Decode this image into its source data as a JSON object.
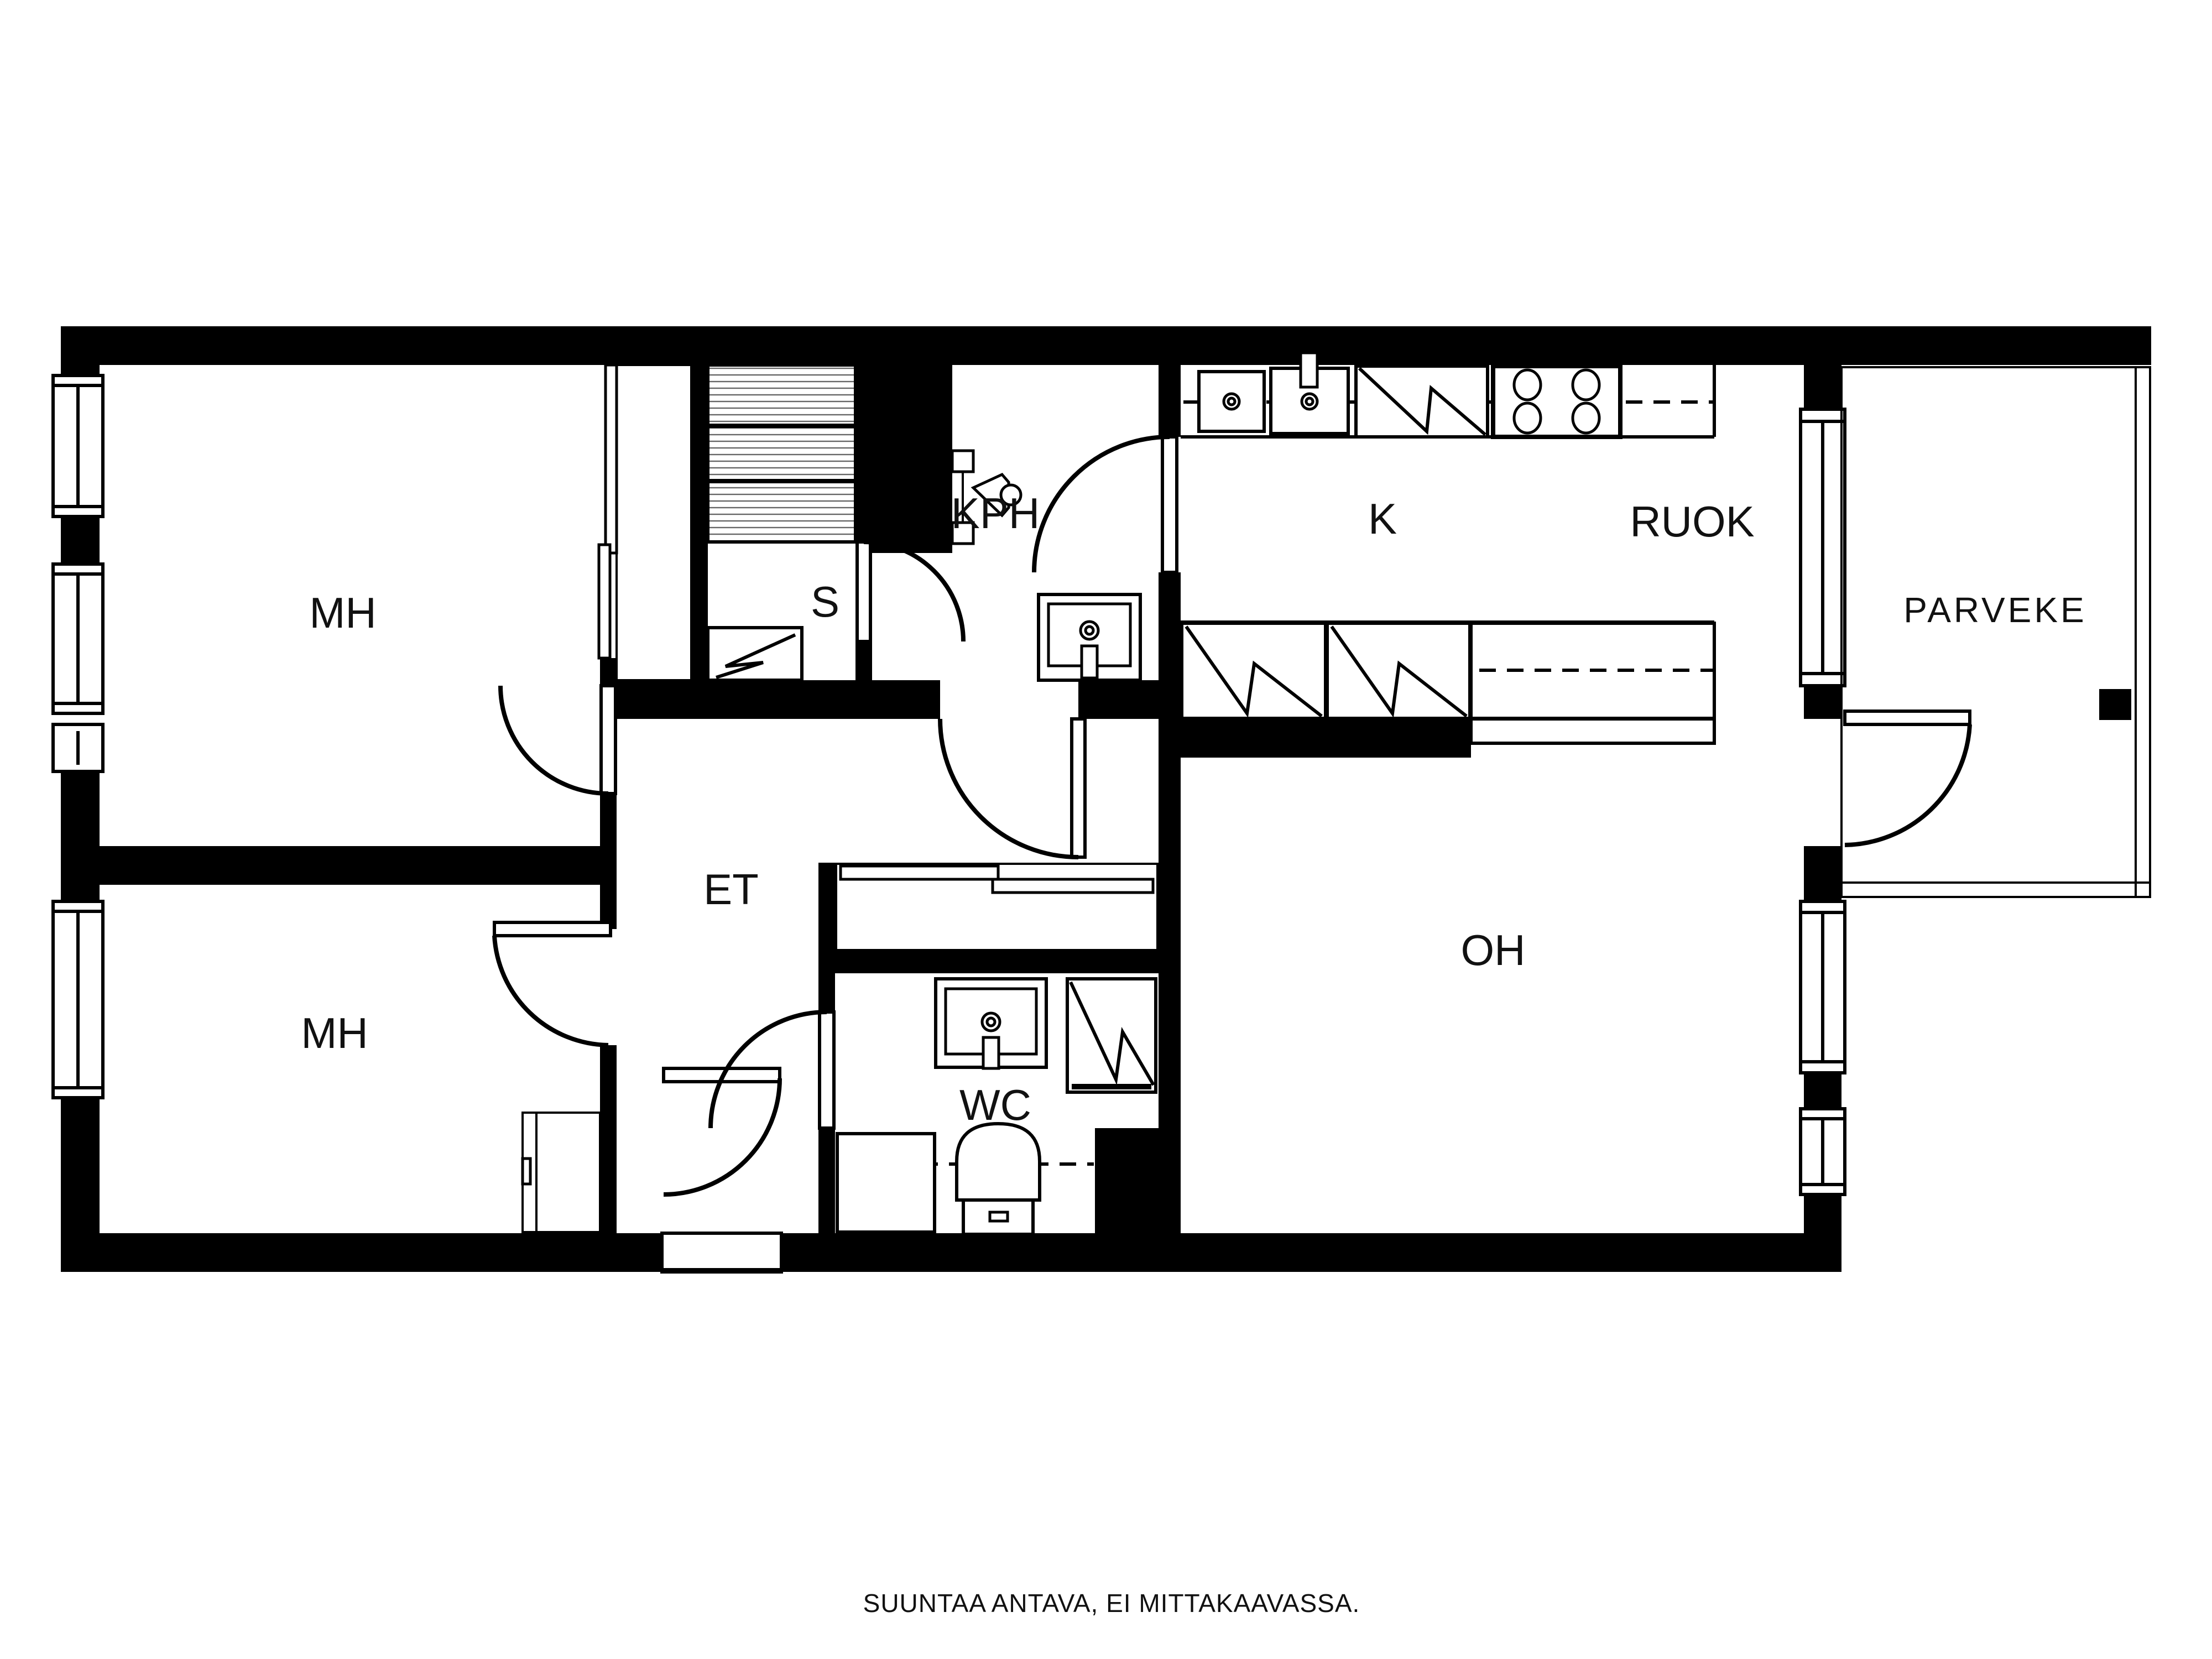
{
  "plan": {
    "type": "apartment-floor-plan",
    "language": "Finnish",
    "rooms": {
      "mh_top": {
        "label": "MH",
        "meaning": "bedroom"
      },
      "mh_bottom": {
        "label": "MH",
        "meaning": "bedroom"
      },
      "sauna": {
        "label": "S",
        "meaning": "sauna"
      },
      "bathroom": {
        "label": "KPH",
        "meaning": "bathroom"
      },
      "kitchen": {
        "label": "K",
        "meaning": "kitchen"
      },
      "dining": {
        "label": "RUOK",
        "meaning": "dining area"
      },
      "balcony": {
        "label": "PARVEKE",
        "meaning": "balcony"
      },
      "hallway": {
        "label": "ET",
        "meaning": "entrance hall"
      },
      "toilet": {
        "label": "WC",
        "meaning": "toilet"
      },
      "living": {
        "label": "OH",
        "meaning": "living room"
      }
    },
    "fixtures": [
      "sauna-benches",
      "sauna-shower",
      "shower-head",
      "bathroom-sink",
      "kitchen-sink-double",
      "dishwasher",
      "stove-4-burners",
      "fridge",
      "freezer",
      "wc-sink",
      "washing-machine",
      "toilet-seat",
      "wc-counter",
      "closet-sliding-doors",
      "wardrobe",
      "balcony-drain"
    ],
    "colors": {
      "wall": "#000000",
      "background": "#ffffff",
      "line": "#111111"
    }
  },
  "footer": {
    "note": "SUUNTAA ANTAVA, EI MITTAKAAVASSA."
  }
}
